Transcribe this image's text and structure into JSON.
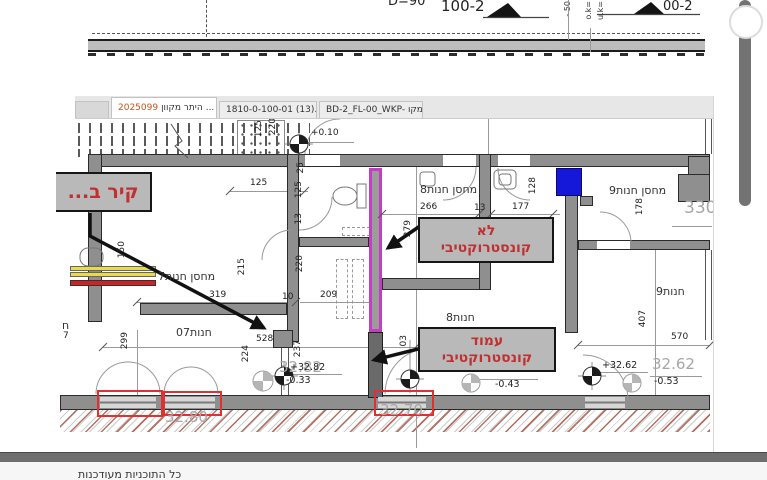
{
  "tabs": {
    "active": {
      "number": "2025099",
      "title": "היתר מקוון",
      "ellipsis": "...",
      "close": "×"
    },
    "tab2": "1810-0-100-01 (13).pdf...",
    "tab3": "BD-2_FL-00_WKP- מקו..."
  },
  "top_strip": {
    "d90": "D=90",
    "label_100_2": "100-2",
    "label_00_2": "00-2",
    "minus50": "- 50",
    "ok": "o.k=",
    "uk": "u.k="
  },
  "annotations": {
    "box_wall": "קיר ב...",
    "box_not_constructive_line1": "לא",
    "box_not_constructive_line2": "קונסטרוקטיבי",
    "box_column_line1": "עמוד",
    "box_column_line2": "קונסטרוקטיבי"
  },
  "plan": {
    "labels": [
      {
        "t": "+0.10",
        "x": 311,
        "y": 129,
        "c": "",
        "n": "level-label"
      },
      {
        "t": "מחסן חנות7",
        "x": 158,
        "y": 271,
        "c": "room rtl",
        "n": "room-label"
      },
      {
        "t": "חנות07",
        "x": 176,
        "y": 327,
        "c": "room rtl",
        "n": "room-label"
      },
      {
        "t": "מחסן חנות8",
        "x": 420,
        "y": 184,
        "c": "room rtl",
        "n": "room-label"
      },
      {
        "t": "חנות8",
        "x": 446,
        "y": 312,
        "c": "room rtl",
        "n": "room-label"
      },
      {
        "t": "מחסן חנות9",
        "x": 609,
        "y": 185,
        "c": "room rtl",
        "n": "room-label"
      },
      {
        "t": "חנות9",
        "x": 656,
        "y": 286,
        "c": "room rtl",
        "n": "room-label"
      },
      {
        "t": "125",
        "x": 250,
        "y": 179,
        "c": "",
        "n": "dim-label"
      },
      {
        "t": "319",
        "x": 209,
        "y": 291,
        "c": "",
        "n": "dim-label"
      },
      {
        "t": "209",
        "x": 320,
        "y": 291,
        "c": "",
        "n": "dim-label"
      },
      {
        "t": "10",
        "x": 282,
        "y": 293,
        "c": "",
        "n": "dim-label"
      },
      {
        "t": "528",
        "x": 256,
        "y": 335,
        "c": "",
        "n": "dim-label"
      },
      {
        "t": "266",
        "x": 420,
        "y": 203,
        "c": "",
        "n": "dim-label"
      },
      {
        "t": "13",
        "x": 474,
        "y": 204,
        "c": "",
        "n": "dim-label"
      },
      {
        "t": "177",
        "x": 512,
        "y": 203,
        "c": "",
        "n": "dim-label"
      },
      {
        "t": "570",
        "x": 671,
        "y": 333,
        "c": "",
        "n": "dim-label"
      },
      {
        "t": "125",
        "x": 255,
        "y": 120,
        "c": "rot",
        "n": "dim-label"
      },
      {
        "t": "220",
        "x": 269,
        "y": 118,
        "c": "rot",
        "n": "dim-label"
      },
      {
        "t": "25",
        "x": 297,
        "y": 162,
        "c": "rot",
        "n": "dim-label"
      },
      {
        "t": "125",
        "x": 295,
        "y": 181,
        "c": "rot",
        "n": "dim-label"
      },
      {
        "t": "13",
        "x": 295,
        "y": 213,
        "c": "rot",
        "n": "dim-label"
      },
      {
        "t": "150",
        "x": 118,
        "y": 241,
        "c": "rot",
        "n": "dim-label"
      },
      {
        "t": "215",
        "x": 238,
        "y": 258,
        "c": "rot",
        "n": "dim-label"
      },
      {
        "t": "220",
        "x": 296,
        "y": 255,
        "c": "rot",
        "n": "dim-label"
      },
      {
        "t": "279",
        "x": 404,
        "y": 220,
        "c": "rot",
        "n": "dim-label"
      },
      {
        "t": "128",
        "x": 529,
        "y": 177,
        "c": "rot",
        "n": "dim-label"
      },
      {
        "t": "299",
        "x": 121,
        "y": 332,
        "c": "rot",
        "n": "dim-label"
      },
      {
        "t": "224",
        "x": 242,
        "y": 345,
        "c": "rot",
        "n": "dim-label"
      },
      {
        "t": "237",
        "x": 294,
        "y": 340,
        "c": "rot",
        "n": "dim-label"
      },
      {
        "t": "03",
        "x": 400,
        "y": 335,
        "c": "rot",
        "n": "dim-label"
      },
      {
        "t": "178",
        "x": 636,
        "y": 198,
        "c": "rot",
        "n": "dim-label"
      },
      {
        "t": "407",
        "x": 639,
        "y": 310,
        "c": "rot",
        "n": "dim-label"
      },
      {
        "t": "32.82",
        "x": 279,
        "y": 360,
        "c": "lvl",
        "n": "elevation-label"
      },
      {
        "t": "32.80",
        "x": 165,
        "y": 410,
        "c": "lvl",
        "n": "elevation-label"
      },
      {
        "t": "32.70",
        "x": 380,
        "y": 403,
        "c": "lvl",
        "n": "elevation-label"
      },
      {
        "t": "32.62",
        "x": 652,
        "y": 357,
        "c": "lvl",
        "n": "elevation-label"
      },
      {
        "t": "330",
        "x": 684,
        "y": 200,
        "c": "lvl big",
        "n": "elevation-label"
      },
      {
        "t": "+32.82",
        "x": 290,
        "y": 363,
        "c": "lvlb",
        "n": "level-label"
      },
      {
        "t": "-0.33",
        "x": 286,
        "y": 376,
        "c": "lvlb",
        "n": "level-label"
      },
      {
        "t": "-0.43",
        "x": 495,
        "y": 380,
        "c": "lvlb",
        "n": "level-label"
      },
      {
        "t": "+32.62",
        "x": 602,
        "y": 361,
        "c": "lvlb",
        "n": "level-label"
      },
      {
        "t": "-0.53",
        "x": 654,
        "y": 377,
        "c": "lvlb",
        "n": "level-label"
      },
      {
        "t": "ח",
        "x": 62,
        "y": 320,
        "c": "room rtl",
        "n": "room-label-partial"
      },
      {
        "t": "7",
        "x": 63,
        "y": 332,
        "c": "",
        "n": "room-label-partial"
      }
    ]
  },
  "status": {
    "text": "כל התוכניות מעודכנות"
  },
  "colors": {
    "magenta_wall": "#c23fc2",
    "blue_column": "#1518d8",
    "annotation_red": "#c03030",
    "box_fill": "#b9b9b9",
    "opening_red": "#e03030",
    "hatch_red": "#aa5a46"
  }
}
